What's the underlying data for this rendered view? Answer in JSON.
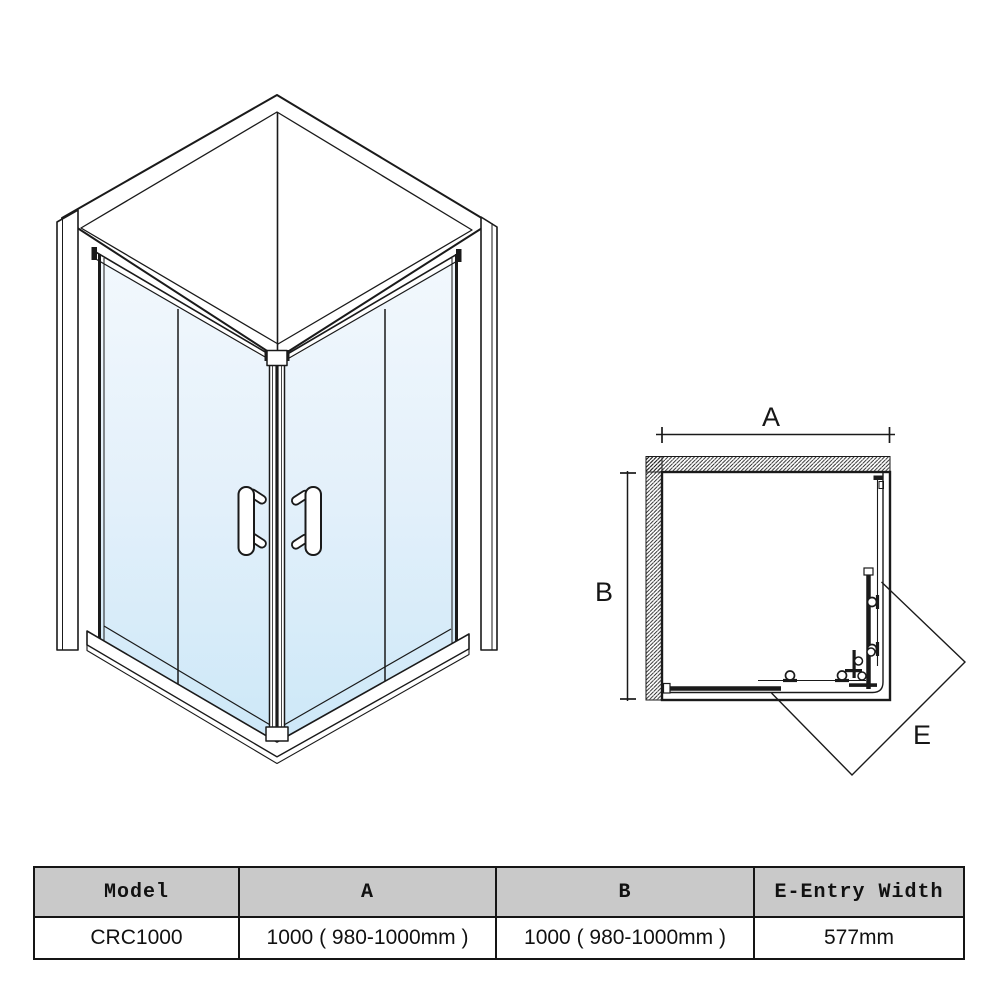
{
  "plan_view": {
    "dim_a_label": "A",
    "dim_b_label": "B",
    "entry_label": "E"
  },
  "spec_table": {
    "headers": [
      "Model",
      "A",
      "B",
      "E-Entry Width"
    ],
    "rows": [
      {
        "model": "CRC1000",
        "a": "1000 ( 980-1000mm )",
        "b": "1000 ( 980-1000mm )",
        "e": "577mm"
      }
    ]
  },
  "colors": {
    "line": "#1a1a1a",
    "glass_top": "#f2f8fd",
    "glass_mid": "#e3f0fa",
    "glass_bottom": "#cde8f8",
    "table_header_bg": "#c9c9c9"
  }
}
